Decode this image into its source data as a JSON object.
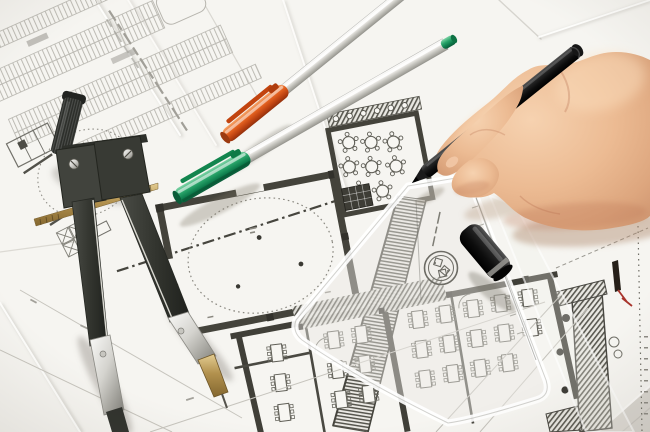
{
  "scene": {
    "type": "photograph",
    "description": "Close-up photo of an architect's right hand holding a black fineliner pen, drawing on overlapping architectural floor-plan blueprints. A metal drafting compass lies across the plans on the left, two silver marker pens with orange and green caps lie in the upper middle, a black pen cap rests on a transparent set-square ruler at lower right.",
    "paper_color": "#f6f5f1",
    "ink_color": "#55544c",
    "objects": {
      "hand": {
        "label": "right hand holding a black pen",
        "skin_tone": "#e8b28a"
      },
      "black_pen": {
        "label": "black fineliner pen",
        "color": "#141414"
      },
      "black_pen_cap": {
        "label": "black pen cap with grey ring",
        "color": "#141414"
      },
      "green_pen": {
        "label": "silver marker pen with green cap",
        "cap_color": "#15894f"
      },
      "orange_pen": {
        "label": "silver marker pen with orange cap",
        "cap_color": "#dd5a1e"
      },
      "compass": {
        "label": "drafting compass with brass adjusting rod",
        "body_color": "#3d3f39",
        "steel_color": "#c9c8c2",
        "brass_color": "#ab8c4f"
      },
      "set_square": {
        "label": "transparent set-square ruler with circular logo stamp"
      },
      "blueprints": {
        "label": "overlapping architectural floor-plan drawings: round dashed hall, restaurant with round tables, parking rows, hatched wall sections"
      }
    }
  }
}
